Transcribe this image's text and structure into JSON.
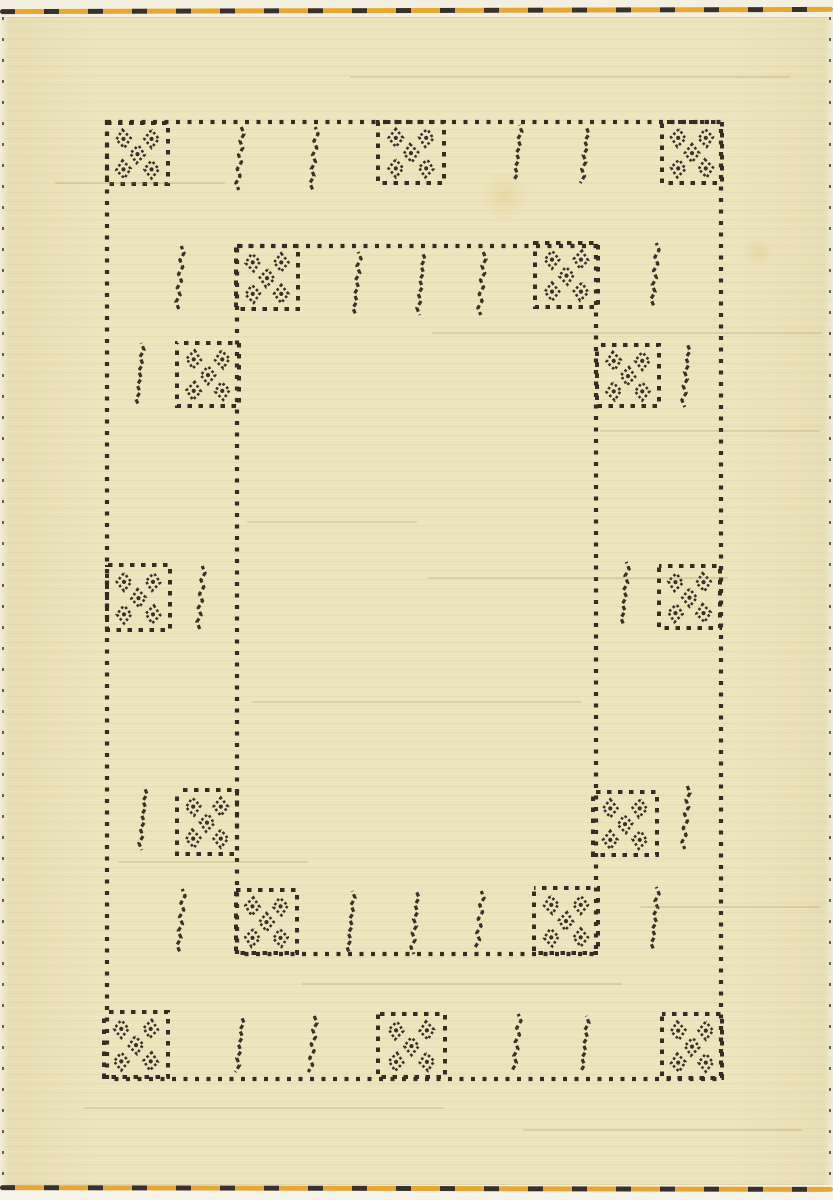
{
  "canvas": {
    "width": 833,
    "height": 1200
  },
  "palette": {
    "rug_cream": "#ece4bd",
    "edge_white": "#f4f0e1",
    "dot_dark": "#352c24",
    "diamond_dark": "#3a3129",
    "stitch_orange": "#e5a32a",
    "stitch_dark": "#2e2721"
  },
  "rug": {
    "outer_border": {
      "x": 107,
      "y": 122,
      "w": 614,
      "h": 957
    },
    "inner_border": {
      "x": 237,
      "y": 246,
      "w": 359,
      "h": 708
    },
    "motif_squares": [
      {
        "x": 107,
        "y": 123,
        "w": 61,
        "h": 61
      },
      {
        "x": 378,
        "y": 122,
        "w": 66,
        "h": 61
      },
      {
        "x": 662,
        "y": 122,
        "w": 60,
        "h": 61
      },
      {
        "x": 236,
        "y": 246,
        "w": 62,
        "h": 63
      },
      {
        "x": 535,
        "y": 243,
        "w": 63,
        "h": 64
      },
      {
        "x": 177,
        "y": 343,
        "w": 62,
        "h": 63
      },
      {
        "x": 597,
        "y": 345,
        "w": 62,
        "h": 61
      },
      {
        "x": 107,
        "y": 565,
        "w": 63,
        "h": 65
      },
      {
        "x": 659,
        "y": 566,
        "w": 61,
        "h": 62
      },
      {
        "x": 177,
        "y": 790,
        "w": 60,
        "h": 64
      },
      {
        "x": 593,
        "y": 792,
        "w": 64,
        "h": 63
      },
      {
        "x": 236,
        "y": 890,
        "w": 61,
        "h": 63
      },
      {
        "x": 534,
        "y": 888,
        "w": 64,
        "h": 65
      },
      {
        "x": 104,
        "y": 1012,
        "w": 64,
        "h": 65
      },
      {
        "x": 378,
        "y": 1014,
        "w": 67,
        "h": 63
      },
      {
        "x": 662,
        "y": 1014,
        "w": 60,
        "h": 64
      }
    ],
    "diamond_layout": [
      [
        0.27,
        0.26
      ],
      [
        0.73,
        0.26
      ],
      [
        0.5,
        0.51
      ],
      [
        0.27,
        0.76
      ],
      [
        0.73,
        0.76
      ]
    ],
    "stitch_lines": [
      {
        "x": 240,
        "y": 127,
        "h": 61
      },
      {
        "x": 314,
        "y": 127,
        "h": 61
      },
      {
        "x": 518,
        "y": 125,
        "h": 57
      },
      {
        "x": 585,
        "y": 127,
        "h": 59
      },
      {
        "x": 180,
        "y": 246,
        "h": 61
      },
      {
        "x": 357,
        "y": 252,
        "h": 62
      },
      {
        "x": 421,
        "y": 252,
        "h": 62
      },
      {
        "x": 482,
        "y": 252,
        "h": 60
      },
      {
        "x": 655,
        "y": 243,
        "h": 64
      },
      {
        "x": 140,
        "y": 343,
        "h": 62
      },
      {
        "x": 686,
        "y": 344,
        "h": 60
      },
      {
        "x": 201,
        "y": 566,
        "h": 63
      },
      {
        "x": 625,
        "y": 562,
        "h": 65
      },
      {
        "x": 143,
        "y": 787,
        "h": 62
      },
      {
        "x": 686,
        "y": 786,
        "h": 62
      },
      {
        "x": 181,
        "y": 889,
        "h": 62
      },
      {
        "x": 351,
        "y": 891,
        "h": 60
      },
      {
        "x": 415,
        "y": 891,
        "h": 60
      },
      {
        "x": 480,
        "y": 891,
        "h": 58
      },
      {
        "x": 655,
        "y": 887,
        "h": 64
      },
      {
        "x": 240,
        "y": 1016,
        "h": 55
      },
      {
        "x": 313,
        "y": 1016,
        "h": 55
      },
      {
        "x": 517,
        "y": 1014,
        "h": 56
      },
      {
        "x": 585,
        "y": 1016,
        "h": 55
      }
    ],
    "weave_streaks": [
      {
        "x": 350,
        "y": 76,
        "w": 440
      },
      {
        "x": 55,
        "y": 182,
        "w": 170
      },
      {
        "x": 432,
        "y": 332,
        "w": 390
      },
      {
        "x": 600,
        "y": 430,
        "w": 220
      },
      {
        "x": 247,
        "y": 521,
        "w": 170
      },
      {
        "x": 428,
        "y": 577,
        "w": 300
      },
      {
        "x": 252,
        "y": 701,
        "w": 330
      },
      {
        "x": 118,
        "y": 861,
        "w": 190
      },
      {
        "x": 640,
        "y": 906,
        "w": 180
      },
      {
        "x": 302,
        "y": 983,
        "w": 320
      },
      {
        "x": 84,
        "y": 1107,
        "w": 360
      },
      {
        "x": 523,
        "y": 1129,
        "w": 280
      }
    ],
    "stains": [
      {
        "x": 505,
        "y": 196,
        "r": 26
      },
      {
        "x": 758,
        "y": 252,
        "r": 16
      }
    ]
  }
}
